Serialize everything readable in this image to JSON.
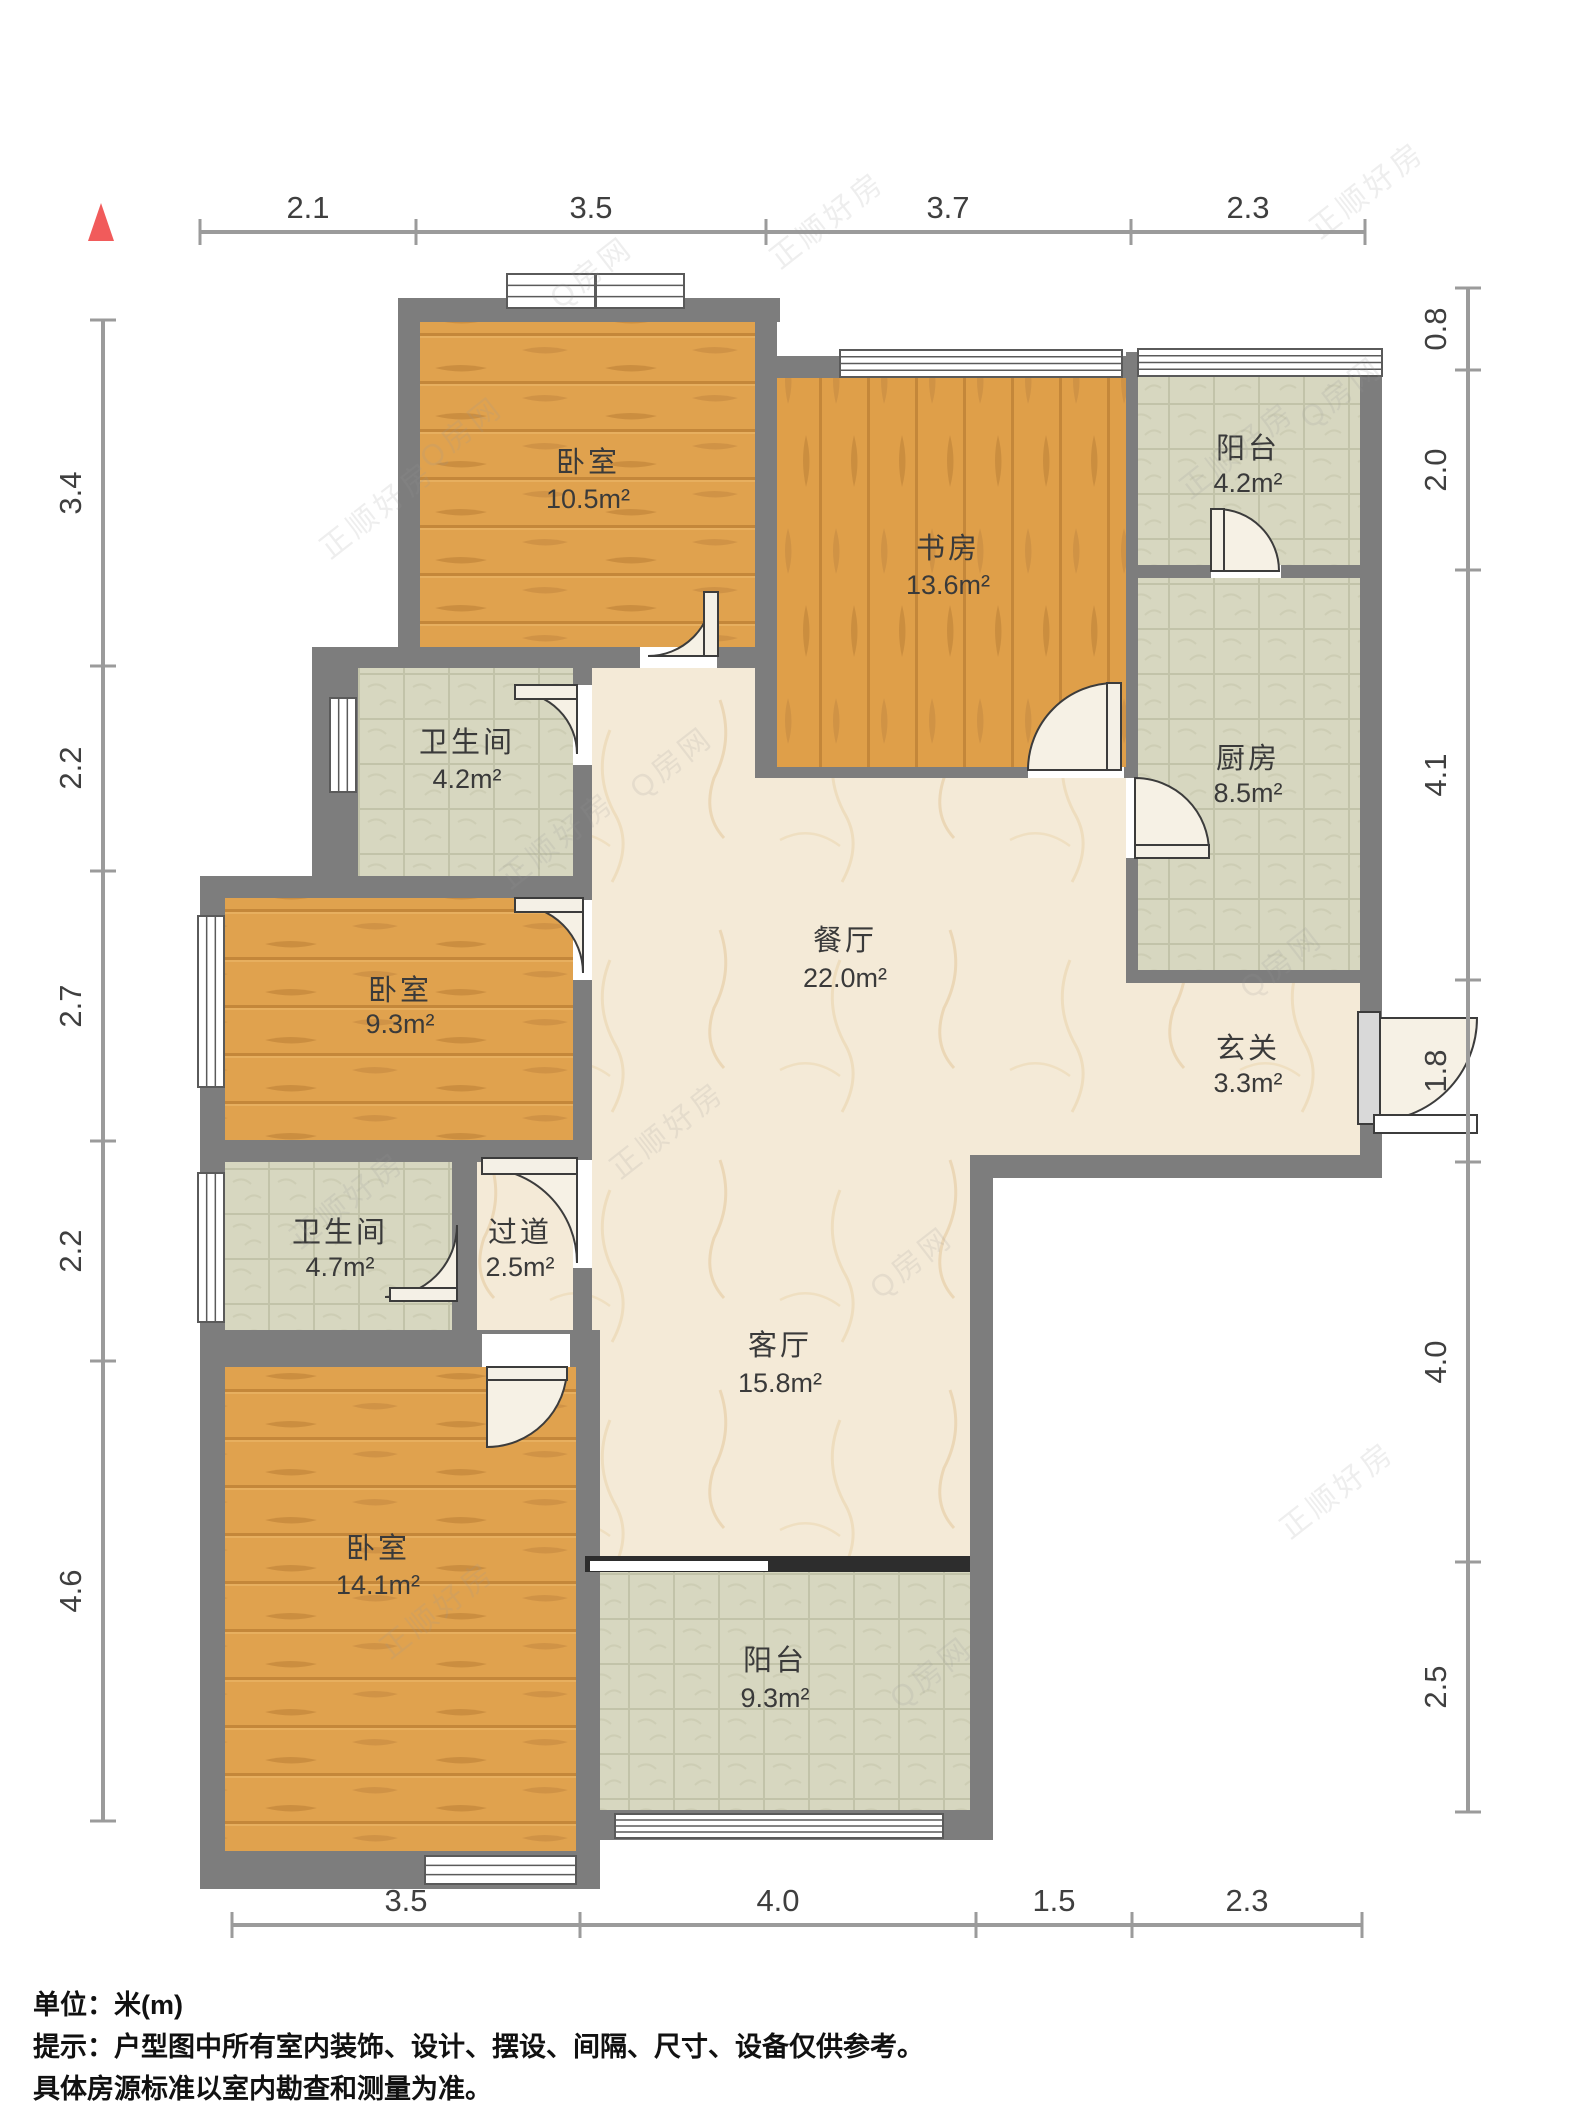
{
  "title": "户型图",
  "footer": {
    "unit_line": "单位：米(m)",
    "tip_line1": "提示：户型图中所有室内装饰、设计、摆设、间隔、尺寸、设备仅供参考。",
    "tip_line2": "具体房源标准以室内勘查和测量为准。"
  },
  "watermark": {
    "texts": [
      "正顺好房",
      "Q房网"
    ],
    "instances": [
      {
        "x": 430,
        "y": 470,
        "t": 1
      },
      {
        "x": 330,
        "y": 560,
        "t": 0
      },
      {
        "x": 560,
        "y": 310,
        "t": 1
      },
      {
        "x": 780,
        "y": 270,
        "t": 0
      },
      {
        "x": 1190,
        "y": 500,
        "t": 0
      },
      {
        "x": 1310,
        "y": 430,
        "t": 1
      },
      {
        "x": 640,
        "y": 800,
        "t": 1
      },
      {
        "x": 510,
        "y": 890,
        "t": 0
      },
      {
        "x": 1250,
        "y": 1000,
        "t": 1
      },
      {
        "x": 1320,
        "y": 240,
        "t": 0
      },
      {
        "x": 300,
        "y": 1250,
        "t": 0
      },
      {
        "x": 880,
        "y": 1300,
        "t": 1
      },
      {
        "x": 390,
        "y": 1660,
        "t": 0
      },
      {
        "x": 900,
        "y": 1710,
        "t": 1
      },
      {
        "x": 1290,
        "y": 1540,
        "t": 0
      },
      {
        "x": 620,
        "y": 1180,
        "t": 0
      }
    ],
    "rotation_deg": -38
  },
  "colors": {
    "wall": "#7d7d7d",
    "wall_dark": "#6f6f6f",
    "wood": "#e0a24e",
    "wood_streak": "#c4873a",
    "tile": "#d7d7c0",
    "tile_line": "#c2c3a9",
    "marble": "#f4ead7",
    "marble_vein": "#e3c69b",
    "window_fill": "#ffffff",
    "window_stroke": "#5a5a5a",
    "door_fill": "#f6f1e5",
    "door_stroke": "#3c3c3c",
    "leaf_fill": "#f4f0e6",
    "entry_leaf": "#d9d9d9",
    "slider_dark": "#2d2d2d",
    "dim_line": "#9b9b9b",
    "compass": "#f15b5b",
    "opening": "#ffffff"
  },
  "compass": {
    "points": "101,203 88,241 114,241"
  },
  "rooms": [
    {
      "id": "bedroom-1",
      "name": "卧室",
      "area": "10.5m²",
      "floor": "wood_h",
      "rect": [
        420,
        322,
        335,
        325
      ],
      "label": [
        588,
        472,
        508
      ]
    },
    {
      "id": "study",
      "name": "书房",
      "area": "13.6m²",
      "floor": "wood_v",
      "rect": [
        777,
        378,
        349,
        389
      ],
      "label": [
        948,
        558,
        594
      ]
    },
    {
      "id": "balcony-1",
      "name": "阳台",
      "area": "4.2m²",
      "floor": "tile",
      "rect": [
        1138,
        375,
        222,
        190
      ],
      "label": [
        1248,
        458,
        492
      ]
    },
    {
      "id": "kitchen",
      "name": "厨房",
      "area": "8.5m²",
      "floor": "tile",
      "rect": [
        1138,
        578,
        222,
        392
      ],
      "label": [
        1248,
        768,
        802
      ]
    },
    {
      "id": "bathroom-1",
      "name": "卫生间",
      "area": "4.2m²",
      "floor": "tile",
      "rect": [
        358,
        668,
        219,
        208
      ],
      "label": [
        467,
        752,
        788
      ]
    },
    {
      "id": "bedroom-2",
      "name": "卧室",
      "area": "9.3m²",
      "floor": "wood_h",
      "rect": [
        222,
        898,
        351,
        242
      ],
      "label": [
        400,
        1000,
        1033
      ]
    },
    {
      "id": "bathroom-2",
      "name": "卫生间",
      "area": "4.7m²",
      "floor": "tile",
      "rect": [
        222,
        1162,
        230,
        168
      ],
      "label": [
        340,
        1242,
        1276
      ]
    },
    {
      "id": "hallway",
      "name": "过道",
      "area": "2.5m²",
      "floor": "marble",
      "rect": [
        462,
        1162,
        115,
        199
      ],
      "label": [
        520,
        1242,
        1276
      ]
    },
    {
      "id": "hall",
      "name": "餐厅",
      "area": "22.0m²",
      "floor": "marble",
      "poly": "592,668 755,668 755,778 1126,778 1126,983 1360,983 1360,1155 970,1155 970,1556 592,1556",
      "label": [
        845,
        950,
        987
      ]
    },
    {
      "id": "foyer",
      "name": "玄关",
      "area": "3.3m²",
      "label": [
        1248,
        1058,
        1092
      ]
    },
    {
      "id": "living",
      "name": "客厅",
      "area": "15.8m²",
      "label": [
        780,
        1355,
        1392
      ]
    },
    {
      "id": "bedroom-3",
      "name": "卧室",
      "area": "14.1m²",
      "floor": "wood_h",
      "rect": [
        225,
        1367,
        351,
        484
      ],
      "label": [
        378,
        1558,
        1594
      ]
    },
    {
      "id": "balcony-2",
      "name": "阳台",
      "area": "9.3m²",
      "floor": "tile",
      "rect": [
        600,
        1572,
        370,
        238
      ],
      "label": [
        775,
        1670,
        1707
      ]
    }
  ],
  "walls": [
    [
      398,
      298,
      382,
      24
    ],
    [
      398,
      298,
      22,
      370
    ],
    [
      755,
      298,
      22,
      480
    ],
    [
      755,
      356,
      383,
      22
    ],
    [
      1126,
      352,
      12,
      631
    ],
    [
      1138,
      352,
      244,
      23
    ],
    [
      1360,
      352,
      22,
      826
    ],
    [
      1138,
      565,
      222,
      13
    ],
    [
      777,
      767,
      349,
      11
    ],
    [
      1126,
      970,
      256,
      13
    ],
    [
      970,
      1155,
      412,
      23
    ],
    [
      970,
      1178,
      23,
      660
    ],
    [
      312,
      647,
      465,
      21
    ],
    [
      312,
      647,
      46,
      229
    ],
    [
      573,
      647,
      19,
      720
    ],
    [
      200,
      876,
      392,
      22
    ],
    [
      200,
      876,
      25,
      1013
    ],
    [
      200,
      1140,
      392,
      22
    ],
    [
      452,
      1152,
      25,
      215
    ],
    [
      200,
      1330,
      392,
      37
    ],
    [
      576,
      1330,
      24,
      559
    ],
    [
      200,
      1851,
      400,
      38
    ],
    [
      576,
      1810,
      417,
      30
    ]
  ],
  "openings": [
    [
      573,
      685,
      19,
      80
    ],
    [
      573,
      900,
      19,
      80
    ],
    [
      573,
      1160,
      19,
      108
    ],
    [
      640,
      647,
      77,
      21
    ],
    [
      482,
      1334,
      88,
      33
    ],
    [
      1126,
      778,
      12,
      80
    ],
    [
      1211,
      565,
      70,
      13
    ],
    [
      1028,
      767,
      96,
      11
    ]
  ],
  "windows": [
    {
      "rect": [
        507,
        274,
        177,
        34
      ],
      "mullion": true
    },
    {
      "rect": [
        840,
        350,
        282,
        27
      ]
    },
    {
      "rect": [
        1138,
        349,
        244,
        27
      ]
    },
    {
      "rect": [
        330,
        698,
        26,
        94
      ]
    },
    {
      "rect": [
        198,
        916,
        26,
        171
      ]
    },
    {
      "rect": [
        198,
        1173,
        26,
        149
      ]
    },
    {
      "rect": [
        425,
        1856,
        151,
        28
      ]
    },
    {
      "rect": [
        615,
        1814,
        328,
        24
      ]
    }
  ],
  "doors": [
    {
      "id": "bedroom-1-door",
      "cx": 712,
      "cy": 656,
      "r": 64,
      "ax": 648,
      "ay": 656,
      "bx": 712,
      "by": 592,
      "sweep": 0,
      "leaf": [
        704,
        592,
        14,
        64
      ]
    },
    {
      "id": "bathroom-1-door",
      "cx": 577,
      "cy": 692,
      "r": 62,
      "ax": 515,
      "ay": 692,
      "bx": 577,
      "by": 754,
      "sweep": 1,
      "leaf": [
        515,
        685,
        62,
        14
      ]
    },
    {
      "id": "bedroom-2-door",
      "cx": 583,
      "cy": 905,
      "r": 68,
      "ax": 515,
      "ay": 905,
      "bx": 583,
      "by": 973,
      "sweep": 1,
      "leaf": [
        515,
        898,
        68,
        14
      ]
    },
    {
      "id": "hallway-door",
      "cx": 577,
      "cy": 1168,
      "r": 95,
      "ax": 482,
      "ay": 1168,
      "bx": 577,
      "by": 1263,
      "sweep": 1,
      "leaf": [
        482,
        1158,
        95,
        16
      ]
    },
    {
      "id": "bathroom-2-door",
      "cx": 457,
      "cy": 1297,
      "r": 72,
      "ax": 385,
      "ay": 1297,
      "bx": 457,
      "by": 1225,
      "sweep": 0,
      "leaf": [
        390,
        1288,
        67,
        13
      ]
    },
    {
      "id": "bedroom-3-door",
      "cx": 487,
      "cy": 1367,
      "r": 80,
      "ax": 567,
      "ay": 1367,
      "bx": 487,
      "by": 1447,
      "sweep": 1,
      "leaf": [
        487,
        1367,
        80,
        13
      ]
    },
    {
      "id": "study-door",
      "cx": 1115,
      "cy": 770,
      "r": 87,
      "ax": 1115,
      "ay": 683,
      "bx": 1028,
      "by": 770,
      "sweep": 0,
      "leaf": [
        1107,
        683,
        14,
        87
      ]
    },
    {
      "id": "kitchen-door",
      "cx": 1135,
      "cy": 852,
      "r": 74,
      "ax": 1209,
      "ay": 852,
      "bx": 1135,
      "by": 778,
      "sweep": 0,
      "leaf": [
        1135,
        845,
        74,
        13
      ]
    },
    {
      "id": "balcony-1-door",
      "cx": 1217,
      "cy": 571,
      "r": 62,
      "ax": 1217,
      "ay": 509,
      "bx": 1279,
      "by": 571,
      "sweep": 1,
      "leaf": [
        1211,
        509,
        13,
        62
      ]
    },
    {
      "id": "entry-door",
      "cx": 1374,
      "cy": 1018,
      "r": 103,
      "ax": 1477,
      "ay": 1018,
      "bx": 1374,
      "by": 1121,
      "sweep": 1,
      "leaf": [
        1358,
        1012,
        22,
        112
      ],
      "entry": true,
      "threshold": [
        1374,
        1115,
        103,
        18
      ]
    }
  ],
  "slider": {
    "dark": [
      585,
      1556,
      385,
      16
    ],
    "gap": [
      590,
      1561,
      178,
      10
    ]
  },
  "dims": {
    "top": {
      "line": [
        200,
        232,
        1365,
        232
      ],
      "ticks": [
        200,
        416,
        766,
        1131,
        1365
      ],
      "labels": [
        {
          "text": "2.1",
          "pos": 308
        },
        {
          "text": "3.5",
          "pos": 591
        },
        {
          "text": "3.7",
          "pos": 948
        },
        {
          "text": "2.3",
          "pos": 1248
        }
      ]
    },
    "bottom": {
      "line": [
        232,
        1925,
        1362,
        1925
      ],
      "ticks": [
        232,
        580,
        976,
        1132,
        1362
      ],
      "labels": [
        {
          "text": "3.5",
          "pos": 406
        },
        {
          "text": "4.0",
          "pos": 778
        },
        {
          "text": "1.5",
          "pos": 1054
        },
        {
          "text": "2.3",
          "pos": 1247
        }
      ]
    },
    "left": {
      "line": [
        103,
        320,
        103,
        1821
      ],
      "ticks": [
        320,
        666,
        871,
        1141,
        1361,
        1821
      ],
      "labels": [
        {
          "text": "3.4",
          "pos": 493
        },
        {
          "text": "2.2",
          "pos": 768
        },
        {
          "text": "2.7",
          "pos": 1006
        },
        {
          "text": "2.2",
          "pos": 1251
        },
        {
          "text": "4.6",
          "pos": 1591
        }
      ]
    },
    "right": {
      "line": [
        1468,
        288,
        1468,
        1812
      ],
      "ticks": [
        288,
        370,
        570,
        980,
        1162,
        1562,
        1812
      ],
      "labels": [
        {
          "text": "0.8",
          "pos": 329
        },
        {
          "text": "2.0",
          "pos": 470
        },
        {
          "text": "4.1",
          "pos": 775
        },
        {
          "text": "1.8",
          "pos": 1071
        },
        {
          "text": "4.0",
          "pos": 1362
        },
        {
          "text": "2.5",
          "pos": 1687
        }
      ]
    }
  }
}
